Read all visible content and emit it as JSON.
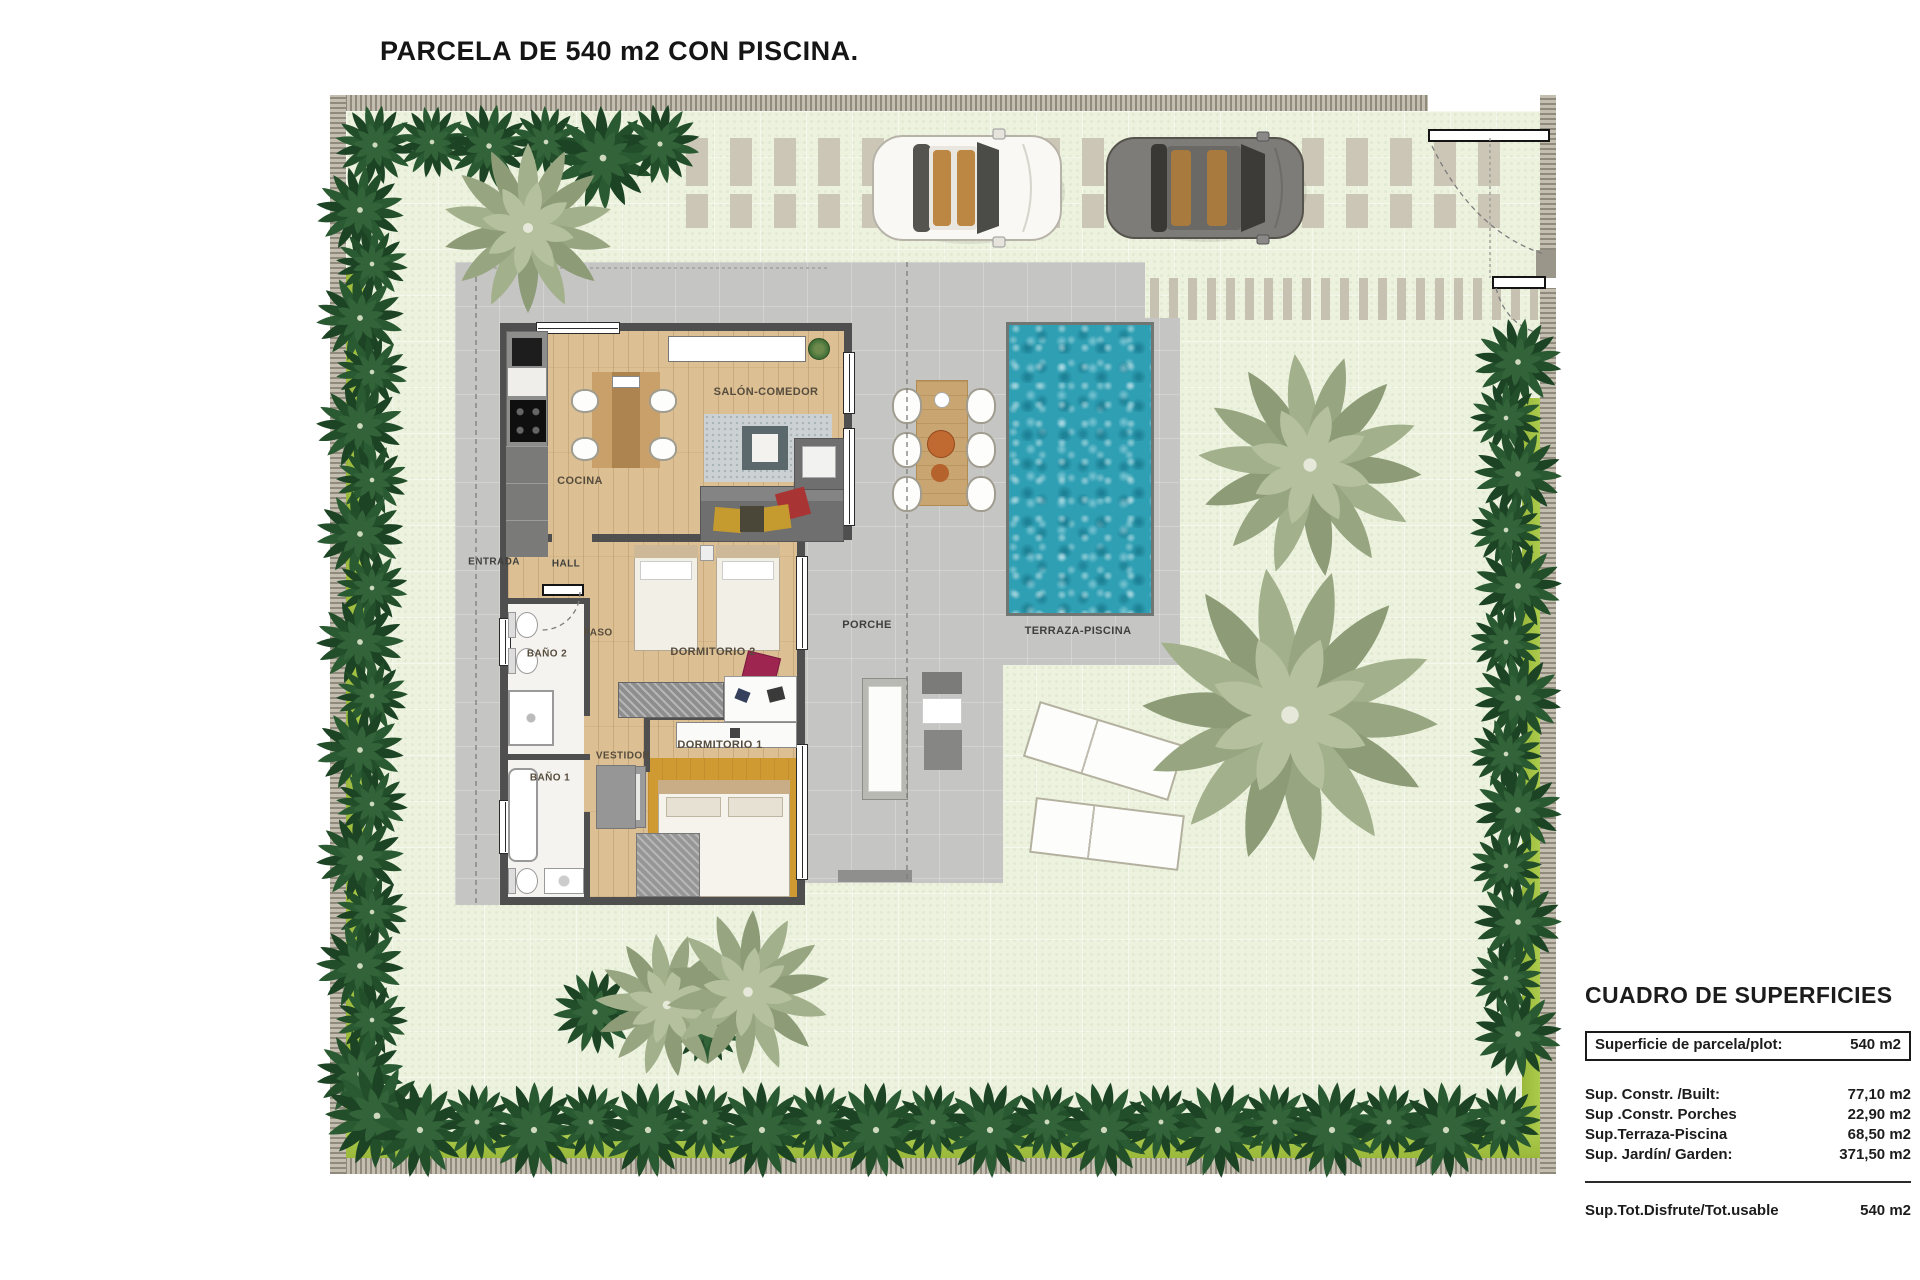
{
  "title": "PARCELA DE 540 m2 CON PISCINA.",
  "rooms": {
    "salon": "SALÓN-COMEDOR",
    "cocina": "COCINA",
    "entrada": "ENTRADA",
    "hall": "HALL",
    "paso": "PASO",
    "bano2": "BAÑO 2",
    "dormitorio2": "DORMITORIO 2",
    "vestidor": "VESTIDOR",
    "bano1": "BAÑO 1",
    "dormitorio1": "DORMITORIO 1",
    "porche": "PORCHE",
    "terraza": "TERRAZA-PISCINA"
  },
  "surface_table": {
    "heading": "CUADRO DE SUPERFICIES",
    "plot_row": {
      "label": "Superficie de parcela/plot:",
      "value": "540 m2"
    },
    "rows": [
      {
        "label": "Sup. Constr. /Built:",
        "value": "77,10 m2"
      },
      {
        "label": "Sup .Constr. Porches",
        "value": "22,90 m2"
      },
      {
        "label": "Sup.Terraza-Piscina",
        "value": "68,50 m2"
      },
      {
        "label": "Sup. Jardín/ Garden:",
        "value": "371,50 m2"
      }
    ],
    "total_row": {
      "label": "Sup.Tot.Disfrute/Tot.usable",
      "value": "540 m2"
    }
  },
  "colors": {
    "lawn": "#ecf2de",
    "hedge": "#a4c243",
    "terrace": "#c5c5c3",
    "pool_water": "#2f9fb3",
    "perimeter_wall": "#b4afa1",
    "house_wall": "#4f4f4f",
    "wood_floor": "#dcc093",
    "bedroom1_floor": "#d09a33"
  }
}
